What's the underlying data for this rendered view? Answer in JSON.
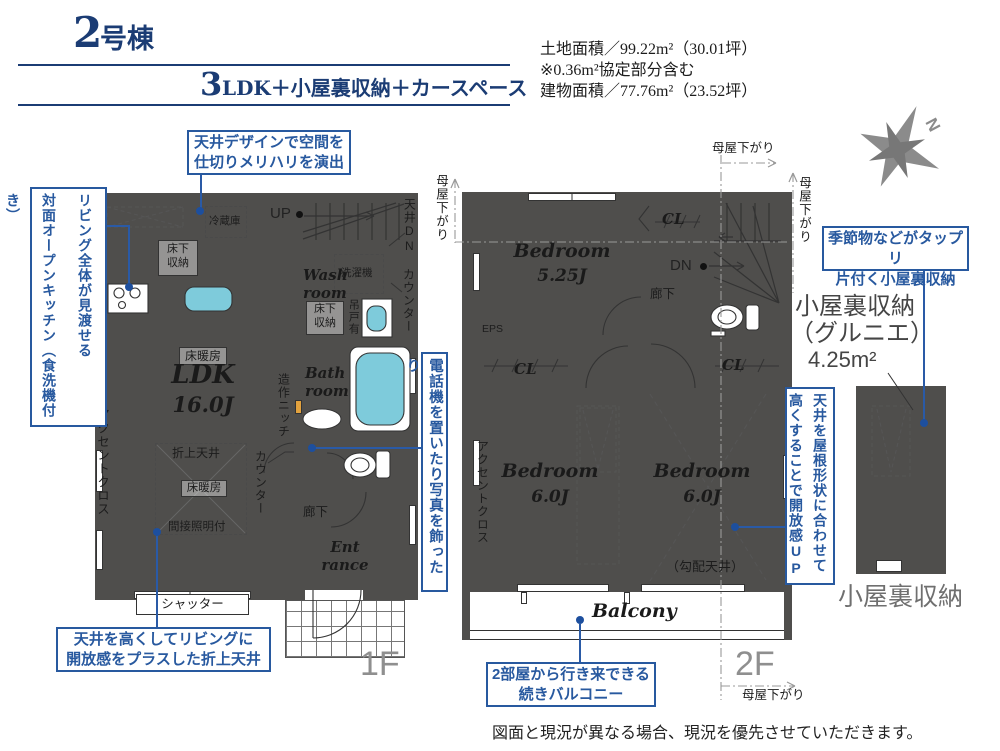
{
  "header": {
    "building_num": "2",
    "building_unit": "号棟",
    "plan_num": "3",
    "plan_text": "LDK＋小屋裏収納＋カースペース",
    "land_area": "土地面積／99.22m²（30.01坪）",
    "land_note": "※0.36m²協定部分含む",
    "building_area": "建物面積／77.76m²（23.52坪）"
  },
  "compass": {
    "north": "N"
  },
  "f1": {
    "label": "1F",
    "up": "UP",
    "fridge": "冷蔵庫",
    "ufs_kitchen": "床下\n収納",
    "ufs_wash": "床下\n収納",
    "washer": "洗濯機",
    "wash_room": "Wash\nroom",
    "bath_room": "Bath\nroom",
    "entrance": "Ent\nrance",
    "hanging_door": "吊戸有",
    "counter_wash": "カウンター",
    "ceiling_dn": "天井DN",
    "counter_ldk": "カウンター",
    "popup_ceiling": "ポップアップ天井",
    "accent_cloth": "アクセントクロス",
    "craft_niche": "造作ニッチ",
    "hallway": "廊下",
    "shutter": "シャッター",
    "floor_heating": "床暖房",
    "ldk_name": "LDK",
    "ldk_size": "16.0J",
    "coffered": "折上天井",
    "coffered_heating": "床暖房",
    "indirect_light": "間接照明付"
  },
  "f2": {
    "label": "2F",
    "bed1": "Bedroom",
    "bed1_size": "5.25J",
    "bed2": "Bedroom",
    "bed2_size": "6.0J",
    "bed3": "Bedroom",
    "bed3_size": "6.0J",
    "cl1": "CL",
    "cl2": "CL",
    "cl3": "CL",
    "dn": "DN",
    "hallway": "廊下",
    "eps": "EPS",
    "accent_cloth": "アクセントクロス",
    "sloped_ceiling": "（勾配天井）",
    "balcony": "Balcony",
    "moya_left": "母屋下がり",
    "moya_top": "母屋下がり",
    "moya_right": "母屋下がり",
    "moya_bottom": "母屋下がり"
  },
  "attic": {
    "title_1": "小屋裏収納",
    "title_2": "（グルニエ）",
    "title_3": "4.25m²",
    "caption": "小屋裏収納"
  },
  "callouts": {
    "ceiling_design": "天井デザインで空間を\n仕切りメリハリを演出",
    "open_kitchen": "リビング全体が見渡せる\n対面オープンキッチン（食洗機付き）",
    "phone_corner": "電話機を置いたり写真を飾ったり",
    "raised_ceiling": "天井を高くしてリビングに\n開放感をプラスした折上天井",
    "attic_storage": "季節物などがタップリ\n片付く小屋裏収納",
    "sloped_open": "天井を屋根形状に合わせて\n高くすることで開放感UP",
    "balcony_link": "2部屋から行き来できる\n続きバルコニー"
  },
  "footer": {
    "disclaimer": "図面と現況が異なる場合、現況を優先させていただきます。"
  }
}
